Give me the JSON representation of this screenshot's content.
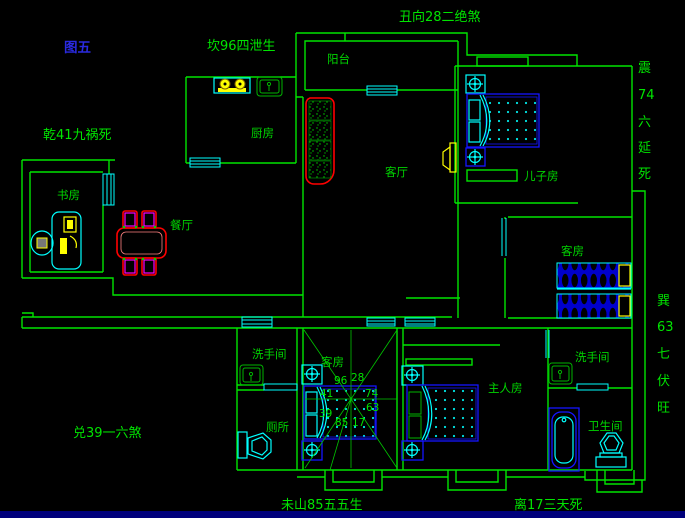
{
  "figure_label": "图五",
  "fengshui": {
    "north": "坎96四泄生",
    "northeast": "丑向28二绝煞",
    "east_vertical": [
      "震",
      "74",
      "六",
      "延",
      "死"
    ],
    "southeast_vertical": [
      "巽",
      "63",
      "七",
      "伏",
      "旺"
    ],
    "south": "离17三天死",
    "southwest": "未山85五五生",
    "west": "兑39一六煞",
    "northwest": "乾41九祸死"
  },
  "rooms": {
    "balcony": "阳台",
    "kitchen": "厨房",
    "study": "书房",
    "dining": "餐厅",
    "living": "客厅",
    "sons_room": "儿子房",
    "guest_room_right": "客房",
    "guest_room_center": "客房",
    "master_bedroom": "主人房",
    "washroom_left": "洗手间",
    "washroom_right": "洗手间",
    "toilet": "厕所",
    "bathroom": "卫生间"
  },
  "compass_numbers": [
    "96",
    "28",
    "41",
    "74",
    "39",
    "63",
    "85",
    "17"
  ],
  "colors": {
    "wall_green": "#00E400",
    "window_cyan": "#00FFFF",
    "furniture_blue": "#1414FF",
    "accent_yellow": "#FFFF00",
    "accent_red": "#FF0000",
    "accent_magenta": "#FF00FF",
    "figure_label_blue": "#2A2AE0",
    "bottom_bar": "#00007B"
  }
}
